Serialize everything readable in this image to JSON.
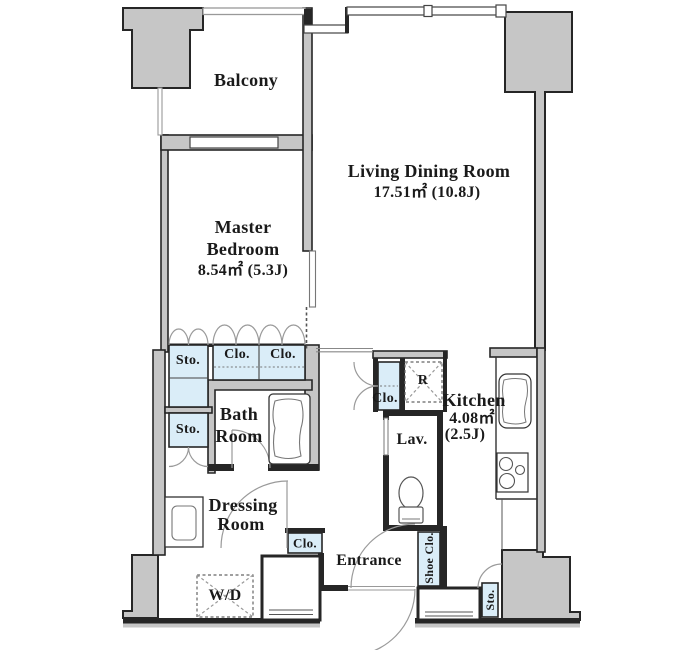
{
  "colors": {
    "wall_fill": "#c6c6c6",
    "wall_line": "#262626",
    "closet_fill": "#daedf8",
    "swing_line": "#9a9a9a"
  },
  "rooms": {
    "balcony": {
      "label": "Balcony"
    },
    "living_dining": {
      "name": "Living Dining Room",
      "area": "17.51㎡ (10.8J)"
    },
    "master_bedroom": {
      "name_line1": "Master",
      "name_line2": "Bedroom",
      "area": "8.54㎡ (5.3J)"
    },
    "bath": {
      "name_line1": "Bath",
      "name_line2": "Room"
    },
    "dressing": {
      "name_line1": "Dressing",
      "name_line2": "Room"
    },
    "kitchen": {
      "name": "Kitchen",
      "area_line1": "4.08㎡",
      "area_line2": "(2.5J)"
    },
    "lavatory": {
      "label": "Lav."
    },
    "entrance": {
      "label": "Entrance"
    }
  },
  "closets": {
    "storage_upper": {
      "label": "Sto."
    },
    "storage_lower": {
      "label": "Sto."
    },
    "closet_left": {
      "label": "Clo."
    },
    "closet_right": {
      "label": "Clo."
    },
    "hall_closet": {
      "label": "Clo."
    },
    "entrance_closet": {
      "label": "Clo."
    },
    "shoe_closet": {
      "label": "Shoe Clo."
    },
    "storage_bottom": {
      "label": "Sto."
    }
  },
  "fixtures": {
    "refrigerator": {
      "label": "R"
    },
    "washer_dryer": {
      "label": "W/D"
    }
  }
}
